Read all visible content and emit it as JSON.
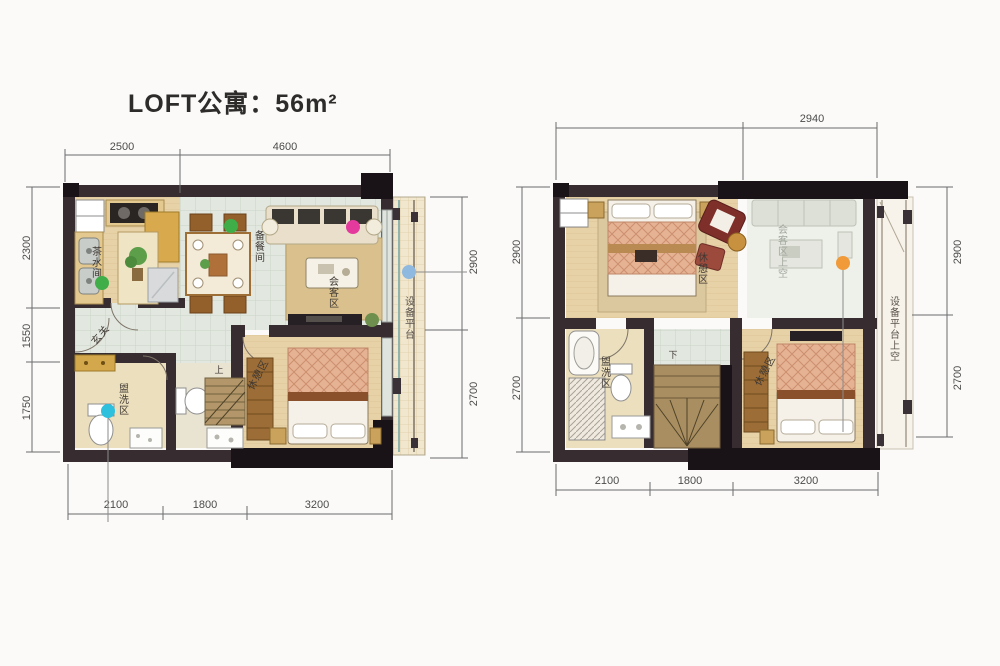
{
  "title": "LOFT公寓：56m²",
  "colors": {
    "marker_green": "#3fae49",
    "marker_pink": "#e43a9e",
    "marker_cyan": "#2ec0dc",
    "marker_blue": "#8fb9de",
    "marker_orange": "#f09a3a"
  },
  "floor1": {
    "dims": {
      "top": [
        "2500",
        "4600"
      ],
      "left": [
        "2300",
        "1550",
        "1750"
      ],
      "right": [
        "2900",
        "2700"
      ],
      "bottom": [
        "2100",
        "1800",
        "3200"
      ]
    },
    "labels": {
      "kitchen": "茶水间",
      "dining": "备餐间",
      "living": "会客区",
      "entry": "玄关",
      "bath": "盥洗区",
      "bedroom": "休憩区",
      "platform": "设备平台",
      "stairs": "上"
    }
  },
  "floor2": {
    "dims": {
      "top": [
        "2940"
      ],
      "left": [
        "2900",
        "2700"
      ],
      "right": [
        "2900",
        "2700"
      ],
      "bottom": [
        "2100",
        "1800",
        "3200"
      ]
    },
    "labels": {
      "bedroom_top": "休憩区",
      "living_void": "会客区上空",
      "bath": "盥洗区",
      "bedroom_bottom": "休憩区",
      "platform_void": "设备平台上空",
      "stairs": "下"
    }
  }
}
